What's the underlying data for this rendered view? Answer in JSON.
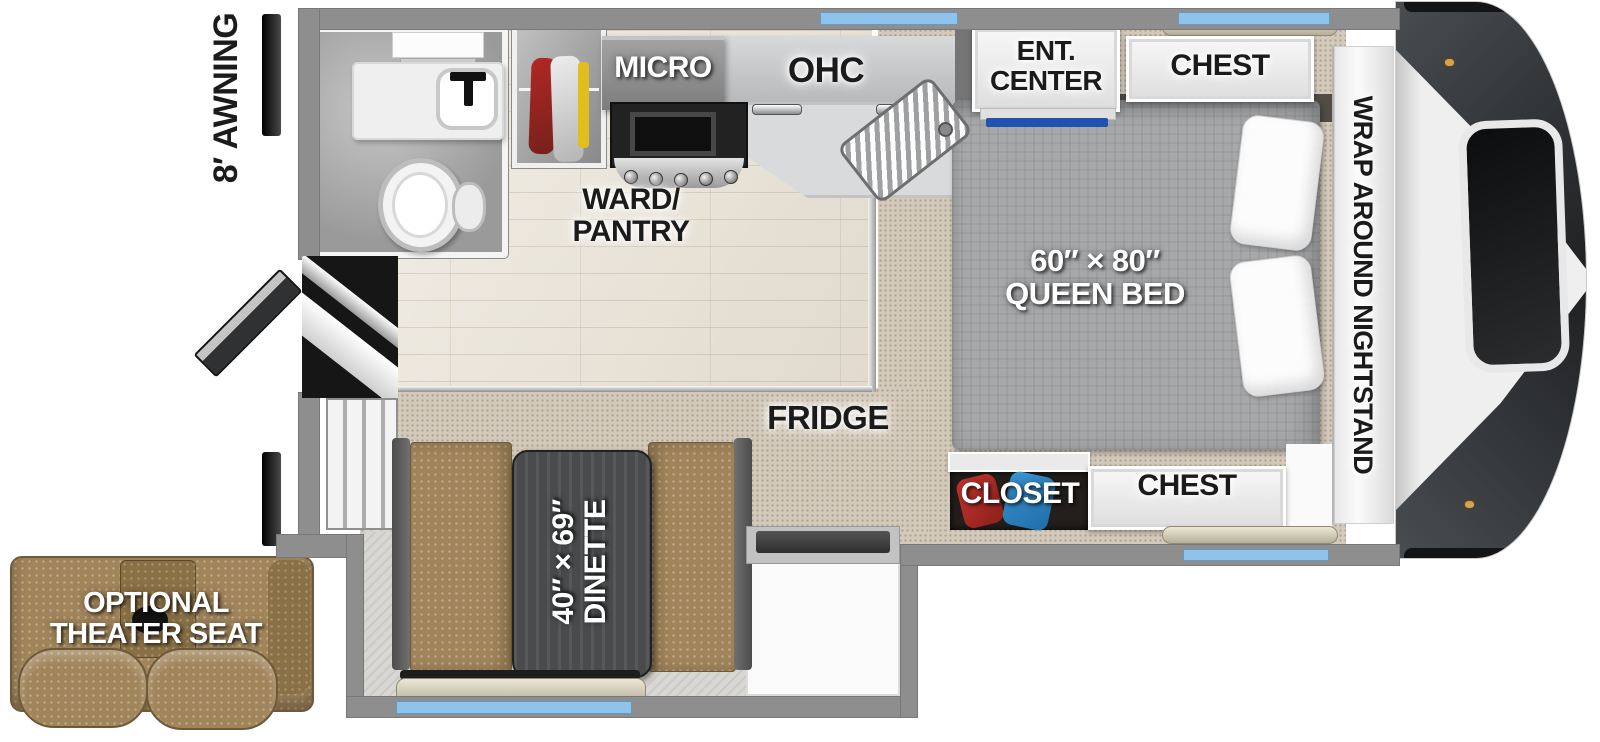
{
  "title": "Truck camper floor plan",
  "labels": {
    "awning": "8′ AWNING",
    "micro": "MICRO",
    "ohc": "OHC",
    "ent_center_1": "ENT.",
    "ent_center_2": "CENTER",
    "chest_top": "CHEST",
    "nightstand": "WRAP AROUND NIGHTSTAND",
    "bed_size": "60″ × 80″",
    "bed_type": "QUEEN BED",
    "ward_pantry_1": "WARD/",
    "ward_pantry_2": "PANTRY",
    "fridge": "FRIDGE",
    "closet": "CLOSET",
    "chest_bottom": "CHEST",
    "dinette_size": "40″ × 69″",
    "dinette": "DINETTE",
    "theater_1": "OPTIONAL",
    "theater_2": "THEATER SEAT"
  },
  "colors": {
    "window_blue": "#8ec4ec",
    "tv_accent_blue": "#2152b0",
    "wall_gray": "#8e8e8e",
    "leather_tan": "#a0845a",
    "table_charcoal": "#494b4d",
    "front_cap_dark": "#3a3d40",
    "carpet_tan": "#d4cabb",
    "wood_floor": "#e8e1d3",
    "closet_clothes_red": "#b32a25",
    "closet_clothes_blue": "#2b7fc2"
  }
}
